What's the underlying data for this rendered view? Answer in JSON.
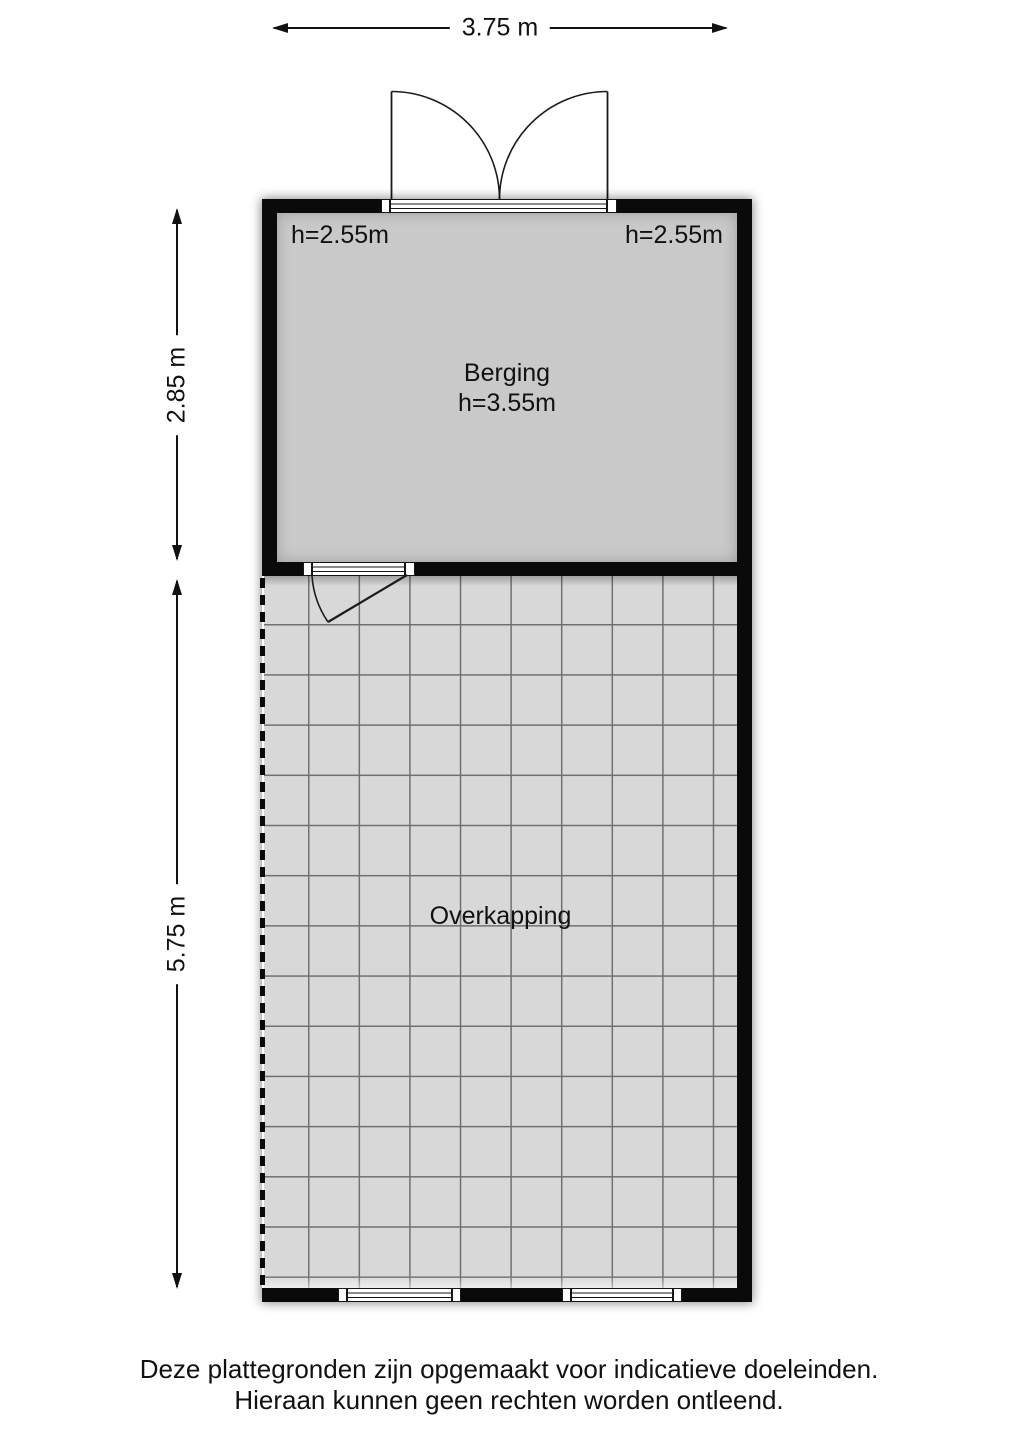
{
  "colors": {
    "wall": "#0a0a0a",
    "line": "#1a1a1a",
    "berging_floor": "#c9c9c9",
    "overkapping_floor": "#d8d8d8",
    "grid_line": "#707070",
    "background": "#ffffff"
  },
  "dimensions": {
    "width_label": "3.75 m",
    "berging_height_label": "2.85 m",
    "overkapping_height_label": "5.75 m"
  },
  "berging": {
    "name": "Berging",
    "ceiling_height": "h=3.55m",
    "height_left": "h=2.55m",
    "height_right": "h=2.55m"
  },
  "overkapping": {
    "name": "Overkapping"
  },
  "footer": {
    "line1": "Deze plattegronden zijn opgemaakt voor indicatieve doeleinden.",
    "line2": "Hieraan kunnen geen rechten worden ontleend."
  }
}
